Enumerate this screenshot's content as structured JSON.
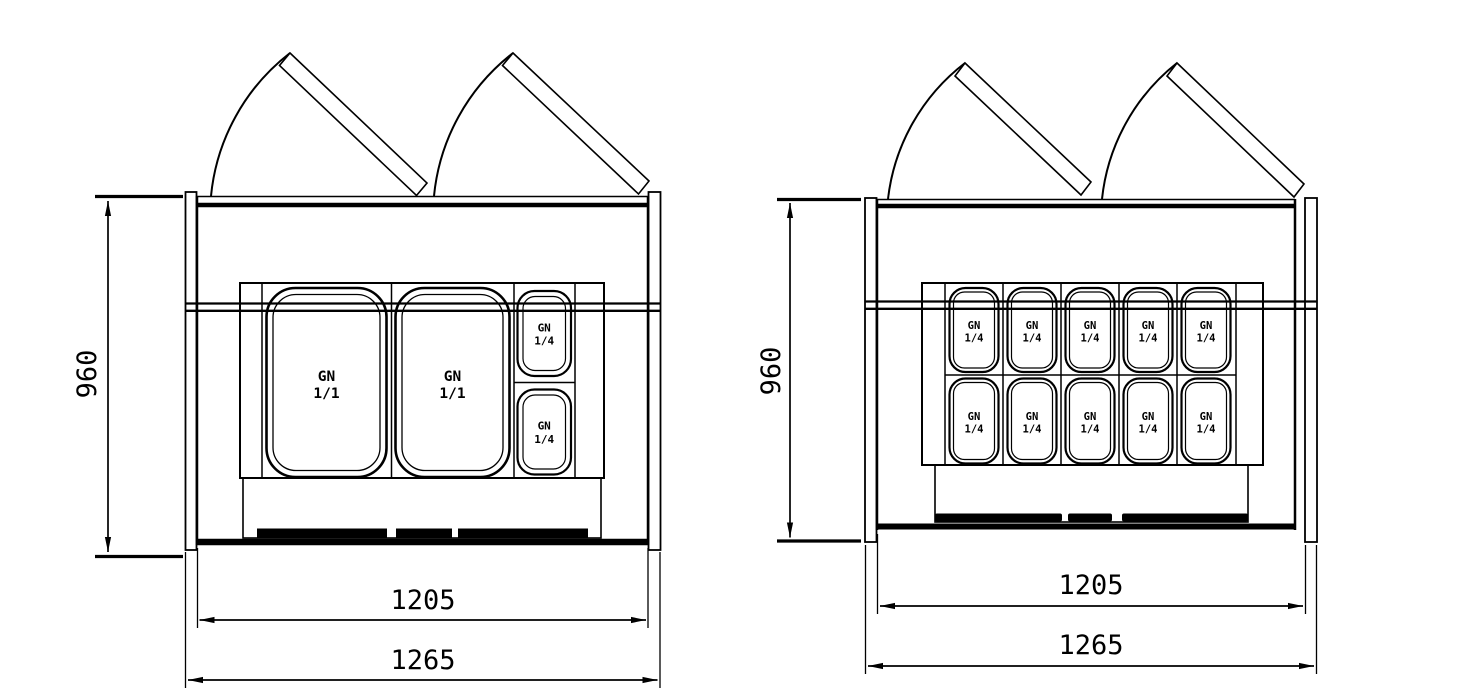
{
  "colors": {
    "line": "#000000",
    "background": "#ffffff"
  },
  "left_drawing": {
    "dimensions": {
      "height": "960",
      "inner_width": "1205",
      "outer_width": "1265"
    },
    "pans": [
      {
        "type": "GN 1/1",
        "line1": "GN",
        "line2": "1/1"
      },
      {
        "type": "GN 1/1",
        "line1": "GN",
        "line2": "1/1"
      },
      {
        "type": "GN 1/4",
        "line1": "GN",
        "line2": "1/4"
      },
      {
        "type": "GN 1/4",
        "line1": "GN",
        "line2": "1/4"
      }
    ]
  },
  "right_drawing": {
    "dimensions": {
      "height": "960",
      "inner_width": "1205",
      "outer_width": "1265"
    },
    "pans": [
      {
        "type": "GN 1/4",
        "line1": "GN",
        "line2": "1/4"
      },
      {
        "type": "GN 1/4",
        "line1": "GN",
        "line2": "1/4"
      },
      {
        "type": "GN 1/4",
        "line1": "GN",
        "line2": "1/4"
      },
      {
        "type": "GN 1/4",
        "line1": "GN",
        "line2": "1/4"
      },
      {
        "type": "GN 1/4",
        "line1": "GN",
        "line2": "1/4"
      },
      {
        "type": "GN 1/4",
        "line1": "GN",
        "line2": "1/4"
      },
      {
        "type": "GN 1/4",
        "line1": "GN",
        "line2": "1/4"
      },
      {
        "type": "GN 1/4",
        "line1": "GN",
        "line2": "1/4"
      },
      {
        "type": "GN 1/4",
        "line1": "GN",
        "line2": "1/4"
      },
      {
        "type": "GN 1/4",
        "line1": "GN",
        "line2": "1/4"
      }
    ]
  }
}
